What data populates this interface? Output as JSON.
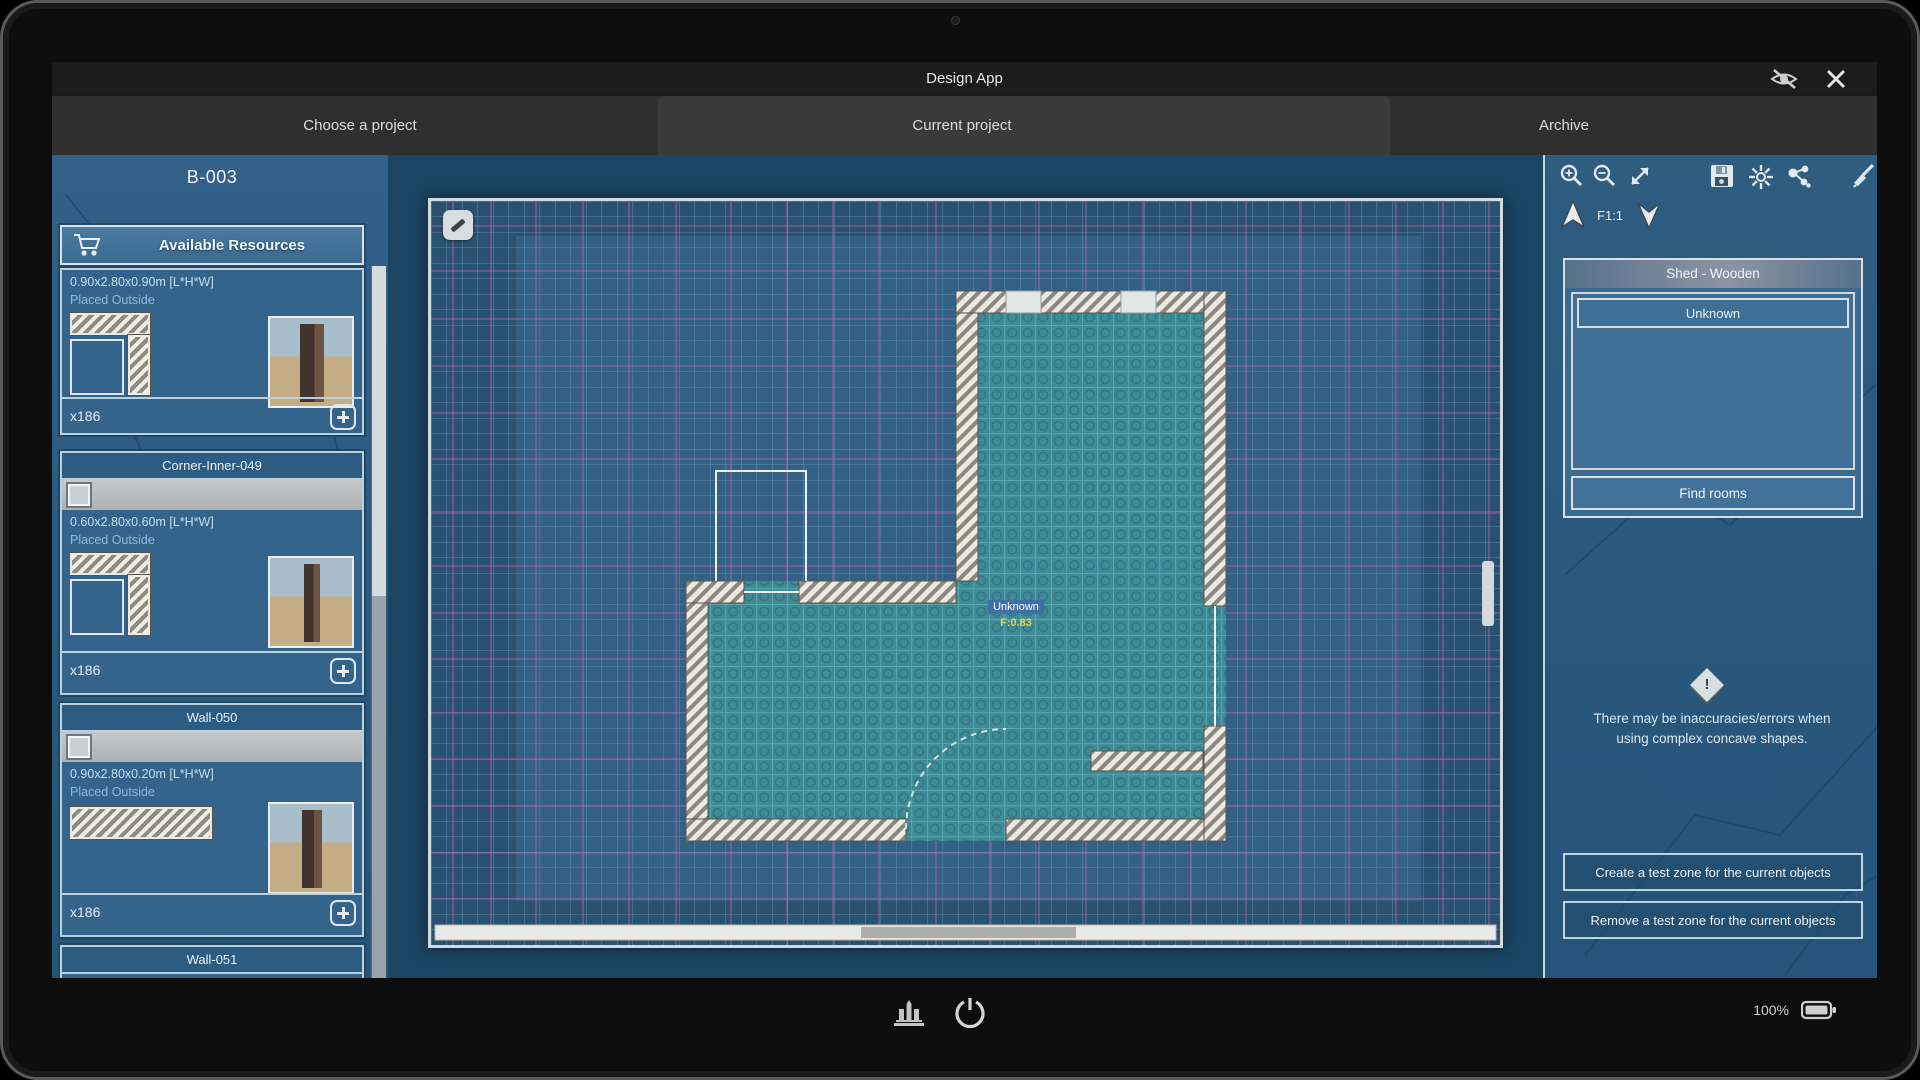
{
  "titlebar": {
    "title": "Design App"
  },
  "tabs": {
    "choose": "Choose a project",
    "current": "Current project",
    "archive": "Archive"
  },
  "leftbar": {
    "project_id": "B-003",
    "header": "Available Resources",
    "cards": [
      {
        "dims": "0.90x2.80x0.90m [L*H*W]",
        "placed": "Placed Outside",
        "count": "x186"
      },
      {
        "title": "Corner-Inner-049",
        "dims": "0.60x2.80x0.60m [L*H*W]",
        "placed": "Placed Outside",
        "count": "x186"
      },
      {
        "title": "Wall-050",
        "dims": "0.90x2.80x0.20m [L*H*W]",
        "placed": "Placed Outside",
        "count": "x186"
      },
      {
        "title": "Wall-051"
      }
    ]
  },
  "canvas": {
    "selection_label": "Unknown",
    "selection_value": "F:0.83"
  },
  "rightbar": {
    "floor_label": "F1:1",
    "panel": {
      "header": "Shed - Wooden",
      "item": "Unknown",
      "find_rooms": "Find rooms"
    },
    "warning_line1": "There may be inaccuracies/errors when",
    "warning_line2": "using complex concave shapes.",
    "buttons": {
      "create": "Create a test zone for the current objects",
      "remove": "Remove a test zone for the current objects"
    }
  },
  "statusbar": {
    "battery": "100%"
  },
  "colors": {
    "grid_line": "#7fb3cf",
    "grid_pink": "#c565b5",
    "room_fill": "#3e8a96",
    "accent_yellow": "#e5d34f"
  }
}
